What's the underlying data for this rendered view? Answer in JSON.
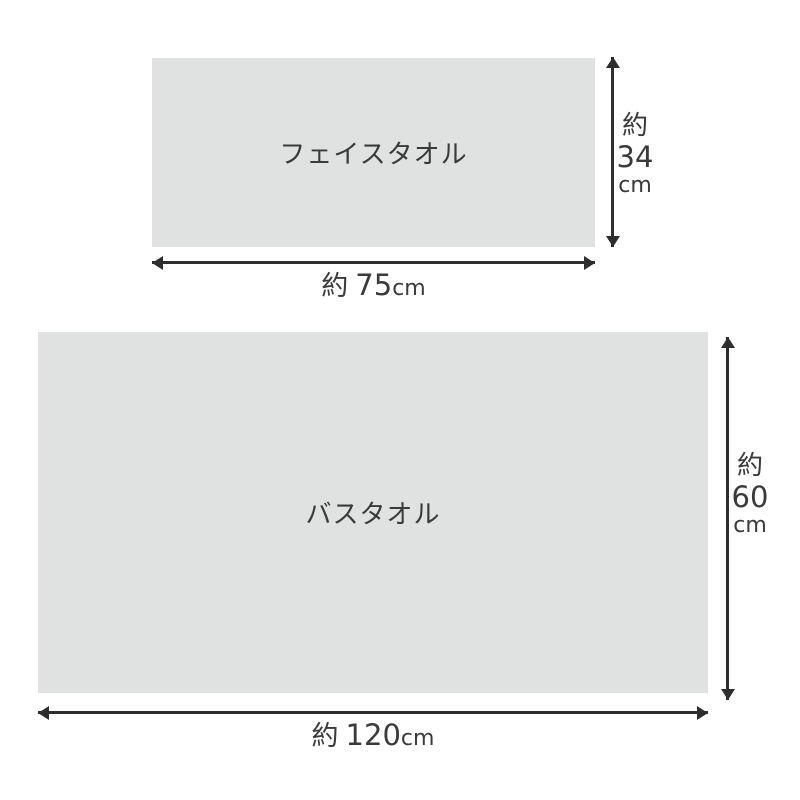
{
  "figure": {
    "face_towel": {
      "label": "フェイスタオル",
      "width": {
        "approx": "約",
        "value": "75",
        "unit": "cm"
      },
      "height": {
        "approx": "約",
        "value": "34",
        "unit": "cm"
      }
    },
    "bath_towel": {
      "label": "バスタオル",
      "width": {
        "approx": "約",
        "value": "120",
        "unit": "cm"
      },
      "height": {
        "approx": "約",
        "value": "60",
        "unit": "cm"
      }
    }
  },
  "colors": {
    "towel_fill": "#e0e2e1",
    "line": "#2e2e2e",
    "text": "#3a3a3a"
  }
}
